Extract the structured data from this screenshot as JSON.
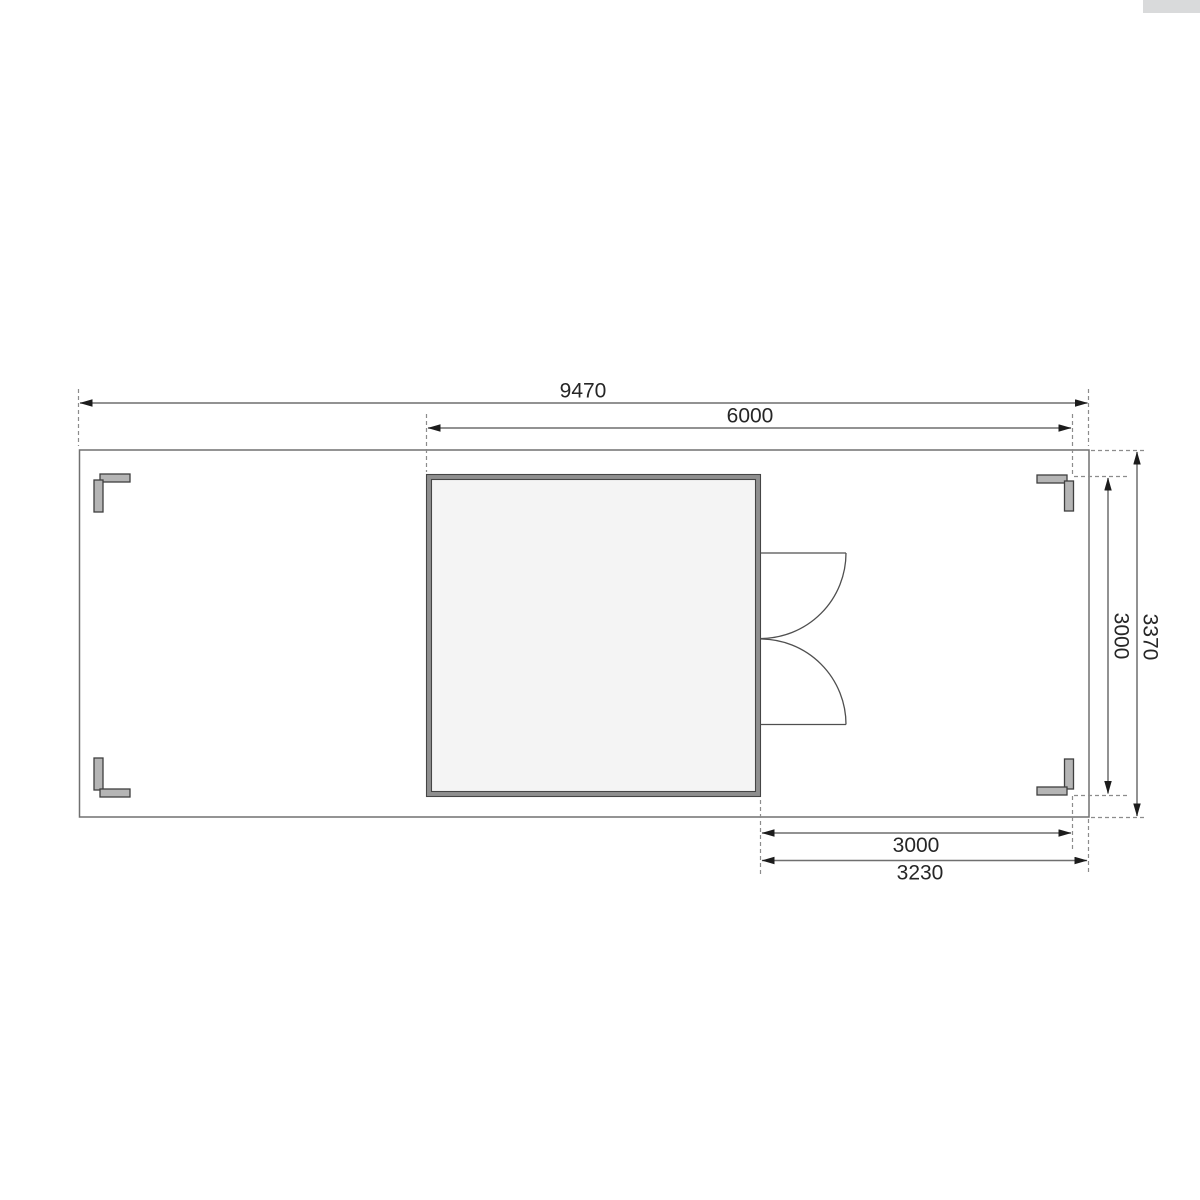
{
  "dimension_labels": {
    "total_width": "9470",
    "span_width": "6000",
    "side_depth_inner": "3000",
    "side_depth_total": "3370",
    "bottom_span_inner": "3000",
    "bottom_span_total": "3230"
  },
  "colors": {
    "background": "#ffffff",
    "outline": "#707070",
    "dimension_line": "#6f6f6f",
    "extension_line": "#8c8c8c",
    "arrowhead": "#1c1c1c",
    "text": "#262626",
    "cabin_wall_band": "#8f8f8f",
    "cabin_wall_edge": "#454545",
    "cabin_floor": "#f4f4f4",
    "post_fill": "#b5b5b5",
    "post_outline": "#3f3f3f",
    "door_line": "#4f4f4f",
    "scrollbar_fragment": "#d9dadb"
  }
}
